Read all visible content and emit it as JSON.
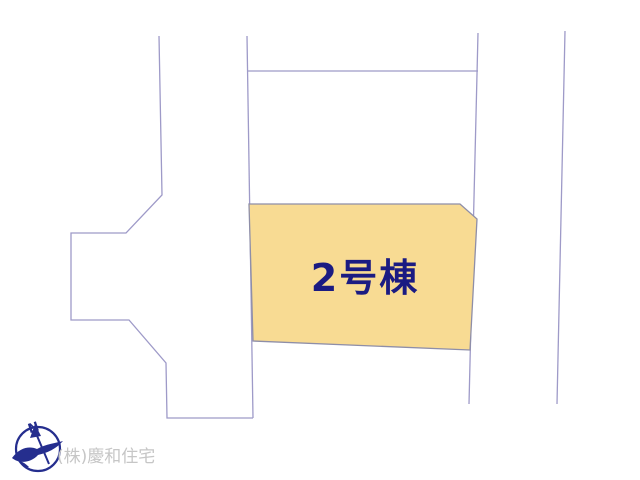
{
  "map": {
    "building_label": "2号棟",
    "colors": {
      "background": "#ffffff",
      "parcel_line": "#9e9ac8",
      "highlight_fill": "#f8db93",
      "highlight_stroke": "#8e8ea8",
      "label_text": "#1b1b82"
    }
  },
  "compass": {
    "north_label": "N",
    "color": "#252e8e"
  },
  "footer": {
    "company_label": "(株)慶和住宅",
    "color": "#c6c6c6"
  }
}
